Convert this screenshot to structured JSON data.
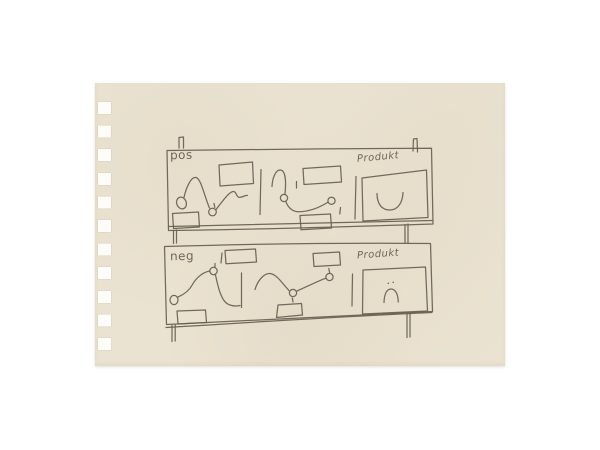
{
  "description": "Pencil sketch on cream spiral-notebook paper: two horizontal panel strips ('pos' and 'neg'), each with three cells — two wavy-curve cells with small node rings and label boxes, and a right 'Produkt' box containing a mouth-like curve (smile up for pos, small frown arc with two dots for neg).",
  "paper": {
    "color": "#ebe3d1",
    "hole_color": "#fdfcf8"
  },
  "ink": {
    "color": "#675e51"
  },
  "panels": [
    {
      "label": "pos",
      "product_label": "Produkt",
      "cells": [
        "wavy curve with open start ring, valley node ring with tick, top label box, bottom label box",
        "hooked curve with two node rings, top label box, bottom label box",
        "large product box with upward smile curve"
      ]
    },
    {
      "label": "neg",
      "product_label": "Produkt",
      "cells": [
        "rising S-curve from start ring to top node ring with tick, top label box, bottom label box",
        "wavy curve with valley node ring and end node ring with ticks, top label box, bottom label box",
        "large product box with small frown arc and two dots"
      ]
    }
  ]
}
